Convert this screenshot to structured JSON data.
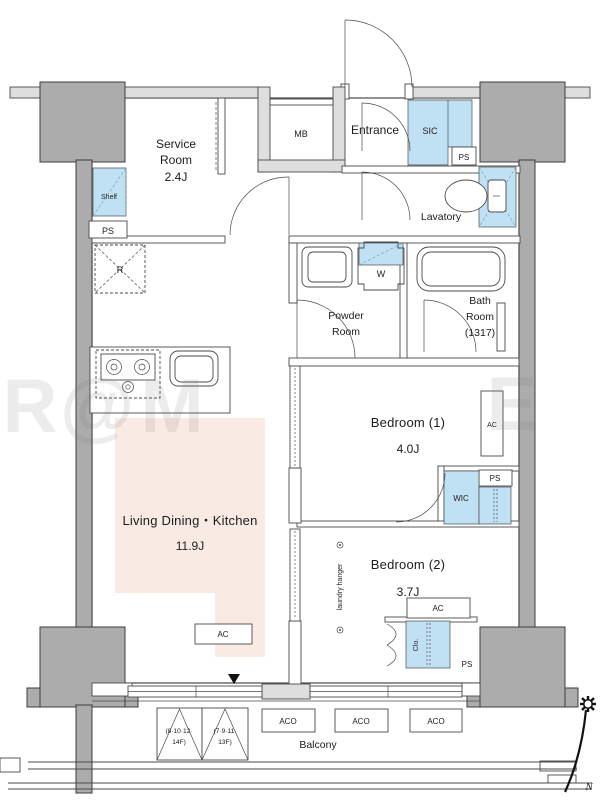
{
  "document_type": "apartment-floor-plan",
  "colors": {
    "pillar_gray": "#acacac",
    "wall_band_gray": "#dedede",
    "fixture_blue": "#bfe1f3",
    "ldk_floor_pink": "#f9eae4",
    "line": "#4a4a4a"
  },
  "rooms": {
    "service_room": {
      "line1": "Service",
      "line2": "Room",
      "size": "2.4J"
    },
    "entrance": {
      "label": "Entrance"
    },
    "lavatory": {
      "label": "Lavatory"
    },
    "powder_room": {
      "line1": "Powder",
      "line2": "Room"
    },
    "bath_room": {
      "line1": "Bath",
      "line2": "Room",
      "size": "(1317)"
    },
    "bedroom_1": {
      "label": "Bedroom (1)",
      "size": "4.0J"
    },
    "bedroom_2": {
      "label": "Bedroom (2)",
      "size": "3.7J"
    },
    "ldk": {
      "label": "Living Dining・Kitchen",
      "size": "11.9J"
    },
    "balcony": {
      "label": "Balcony"
    }
  },
  "fixtures": {
    "meter_box": "MB",
    "shoe_closet": "SIC",
    "pipe_space": "PS",
    "shelf": "Shelf",
    "refrigerator": "R",
    "washing_machine": "W",
    "walk_in_closet": "WIC",
    "closet": "Clo.",
    "laundry_hanger": "laundry hanger",
    "air_conditioner": "AC",
    "ac_outdoor_unit": "ACO"
  },
  "annotations": {
    "hatch_1_line1": "(8·10·12·",
    "hatch_1_line2": "14F)",
    "hatch_2_line1": "(7·9·11·",
    "hatch_2_line2": "13F)",
    "north": "N",
    "watermark_1": "R",
    "watermark_2": "@",
    "watermark_3": "M",
    "watermark_4": "E"
  }
}
